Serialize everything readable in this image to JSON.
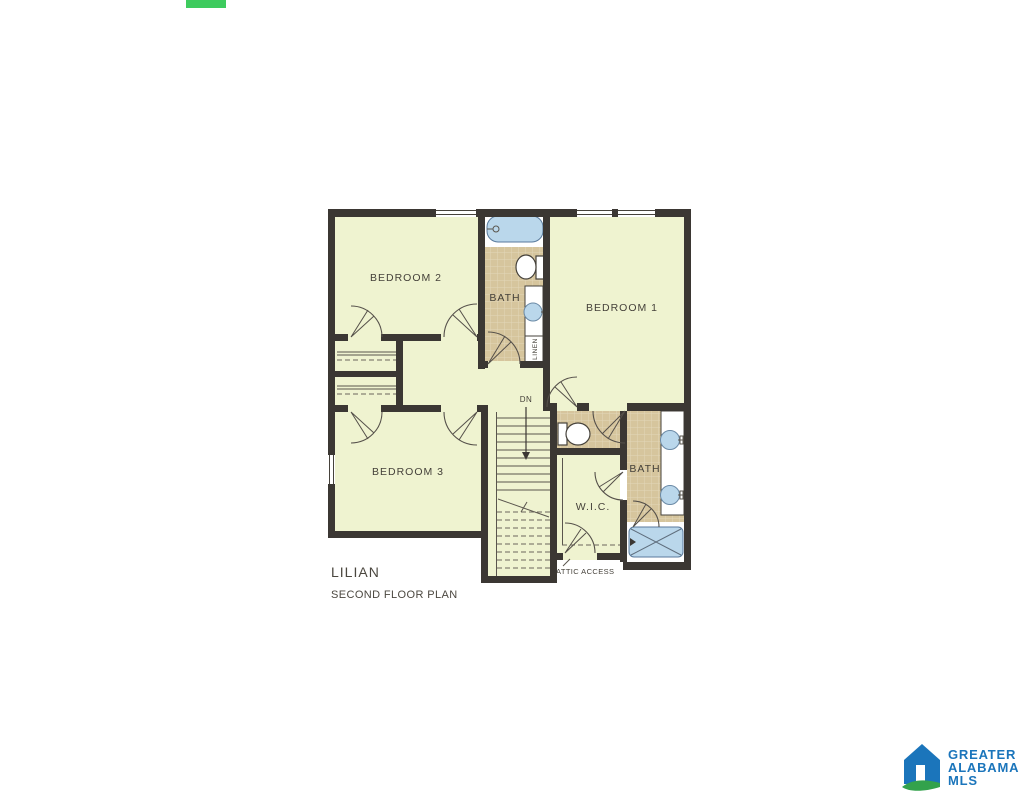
{
  "page": {
    "background_color": "#ffffff",
    "accent_bar_color": "#3ecb5e"
  },
  "plan": {
    "name": "LILIAN",
    "caption": "SECOND FLOOR PLAN",
    "labels": {
      "bedroom1": "BEDROOM 1",
      "bedroom2": "BEDROOM 2",
      "bedroom3": "BEDROOM 3",
      "bath_upper": "BATH",
      "bath_lower": "BATH",
      "wic": "W.I.C.",
      "linen": "LINEN",
      "stairs_down": "DN",
      "attic_access": "ATTIC ACCESS"
    },
    "colors": {
      "wall": "#3b3733",
      "room_fill": "#eff3d0",
      "tile_fill": "#d6c59d",
      "tile_grid": "#e3d6b9",
      "fixture_blue": "#bad7eb",
      "label_text": "#45413a"
    }
  },
  "brand": {
    "lines": [
      "GREATER",
      "ALABAMA",
      "MLS"
    ],
    "logo_blue": "#1b75bb",
    "logo_green": "#33a24c"
  }
}
